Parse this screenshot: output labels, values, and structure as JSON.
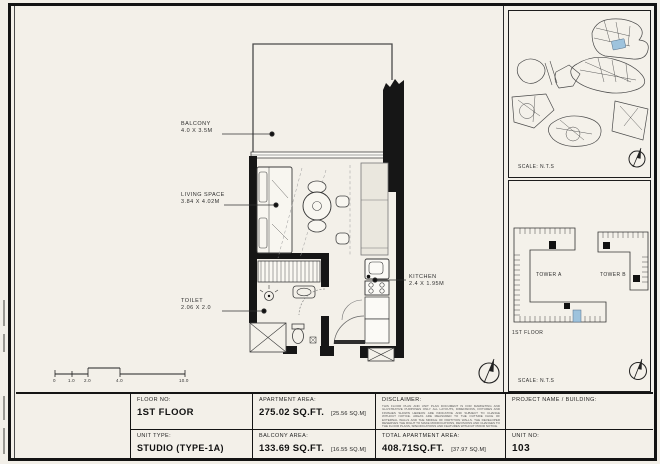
{
  "plan": {
    "rooms": [
      {
        "name": "BALCONY",
        "dims": "4.0 X 3.5M"
      },
      {
        "name": "LIVING SPACE",
        "dims": "3.84 X 4.02M"
      },
      {
        "name": "TOILET",
        "dims": "2.06 X 2.0"
      },
      {
        "name": "KITCHEN",
        "dims": "2.4 X 1.95M"
      }
    ],
    "scale_bar": {
      "ticks": [
        "0",
        "1.0",
        "2.0",
        "4.0",
        "10.0"
      ]
    }
  },
  "site_panel": {
    "scale": "SCALE: N.T.S"
  },
  "key_panel": {
    "tower_a": "TOWER A",
    "tower_b": "TOWER B",
    "floor": "1ST FLOOR",
    "scale": "SCALE: N.T.S"
  },
  "title_block": {
    "floor_no_label": "FLOOR NO:",
    "floor_no": "1ST FLOOR",
    "unit_type_label": "UNIT TYPE:",
    "unit_type": "STUDIO (TYPE-1A)",
    "apartment_area_label": "APARTMENT AREA:",
    "apartment_area": "275.02 SQ.FT.",
    "apartment_area_m": "[25.56 SQ.M]",
    "balcony_area_label": "BALCONY AREA:",
    "balcony_area": "133.69 SQ.FT.",
    "balcony_area_m": "[16.55 SQ.M]",
    "disclaimer_label": "DISCLAIMER:",
    "disclaimer_text": "THIS FLOOR PLAN AND UNIT PLAN DOCUMENT IS FOR MARKETING AND ILLUSTRATIVE PURPOSES ONLY. ALL LAYOUTS, DIMENSIONS, FIXTURES AND FINISHES SHOWN HEREON ARE INDICATIVE AND SUBJECT TO CHANGE WITHOUT NOTICE. AREAS ARE MEASURED TO THE OUTSIDE FACE OF EXTERNAL WALLS AND THE MIDDLE OF PARTITION WALLS. THE DEVELOPER RESERVES THE RIGHT TO MAKE MODIFICATIONS, REVISIONS AND CHANGES TO THE FLOOR PLANS, SPECIFICATIONS AND FEATURES WITHOUT PRIOR NOTICE.",
    "total_area_label": "TOTAL APARTMENT AREA:",
    "total_area": "408.71SQ.FT.",
    "total_area_m": "[37.97 SQ.M]",
    "project_label": "PROJECT NAME / BUILDING:",
    "unit_no_label": "UNIT NO:",
    "unit_no": "103"
  },
  "colors": {
    "background": "#f3f0e9",
    "wall": "#161616",
    "highlight_unit": "#9ec3dd"
  }
}
